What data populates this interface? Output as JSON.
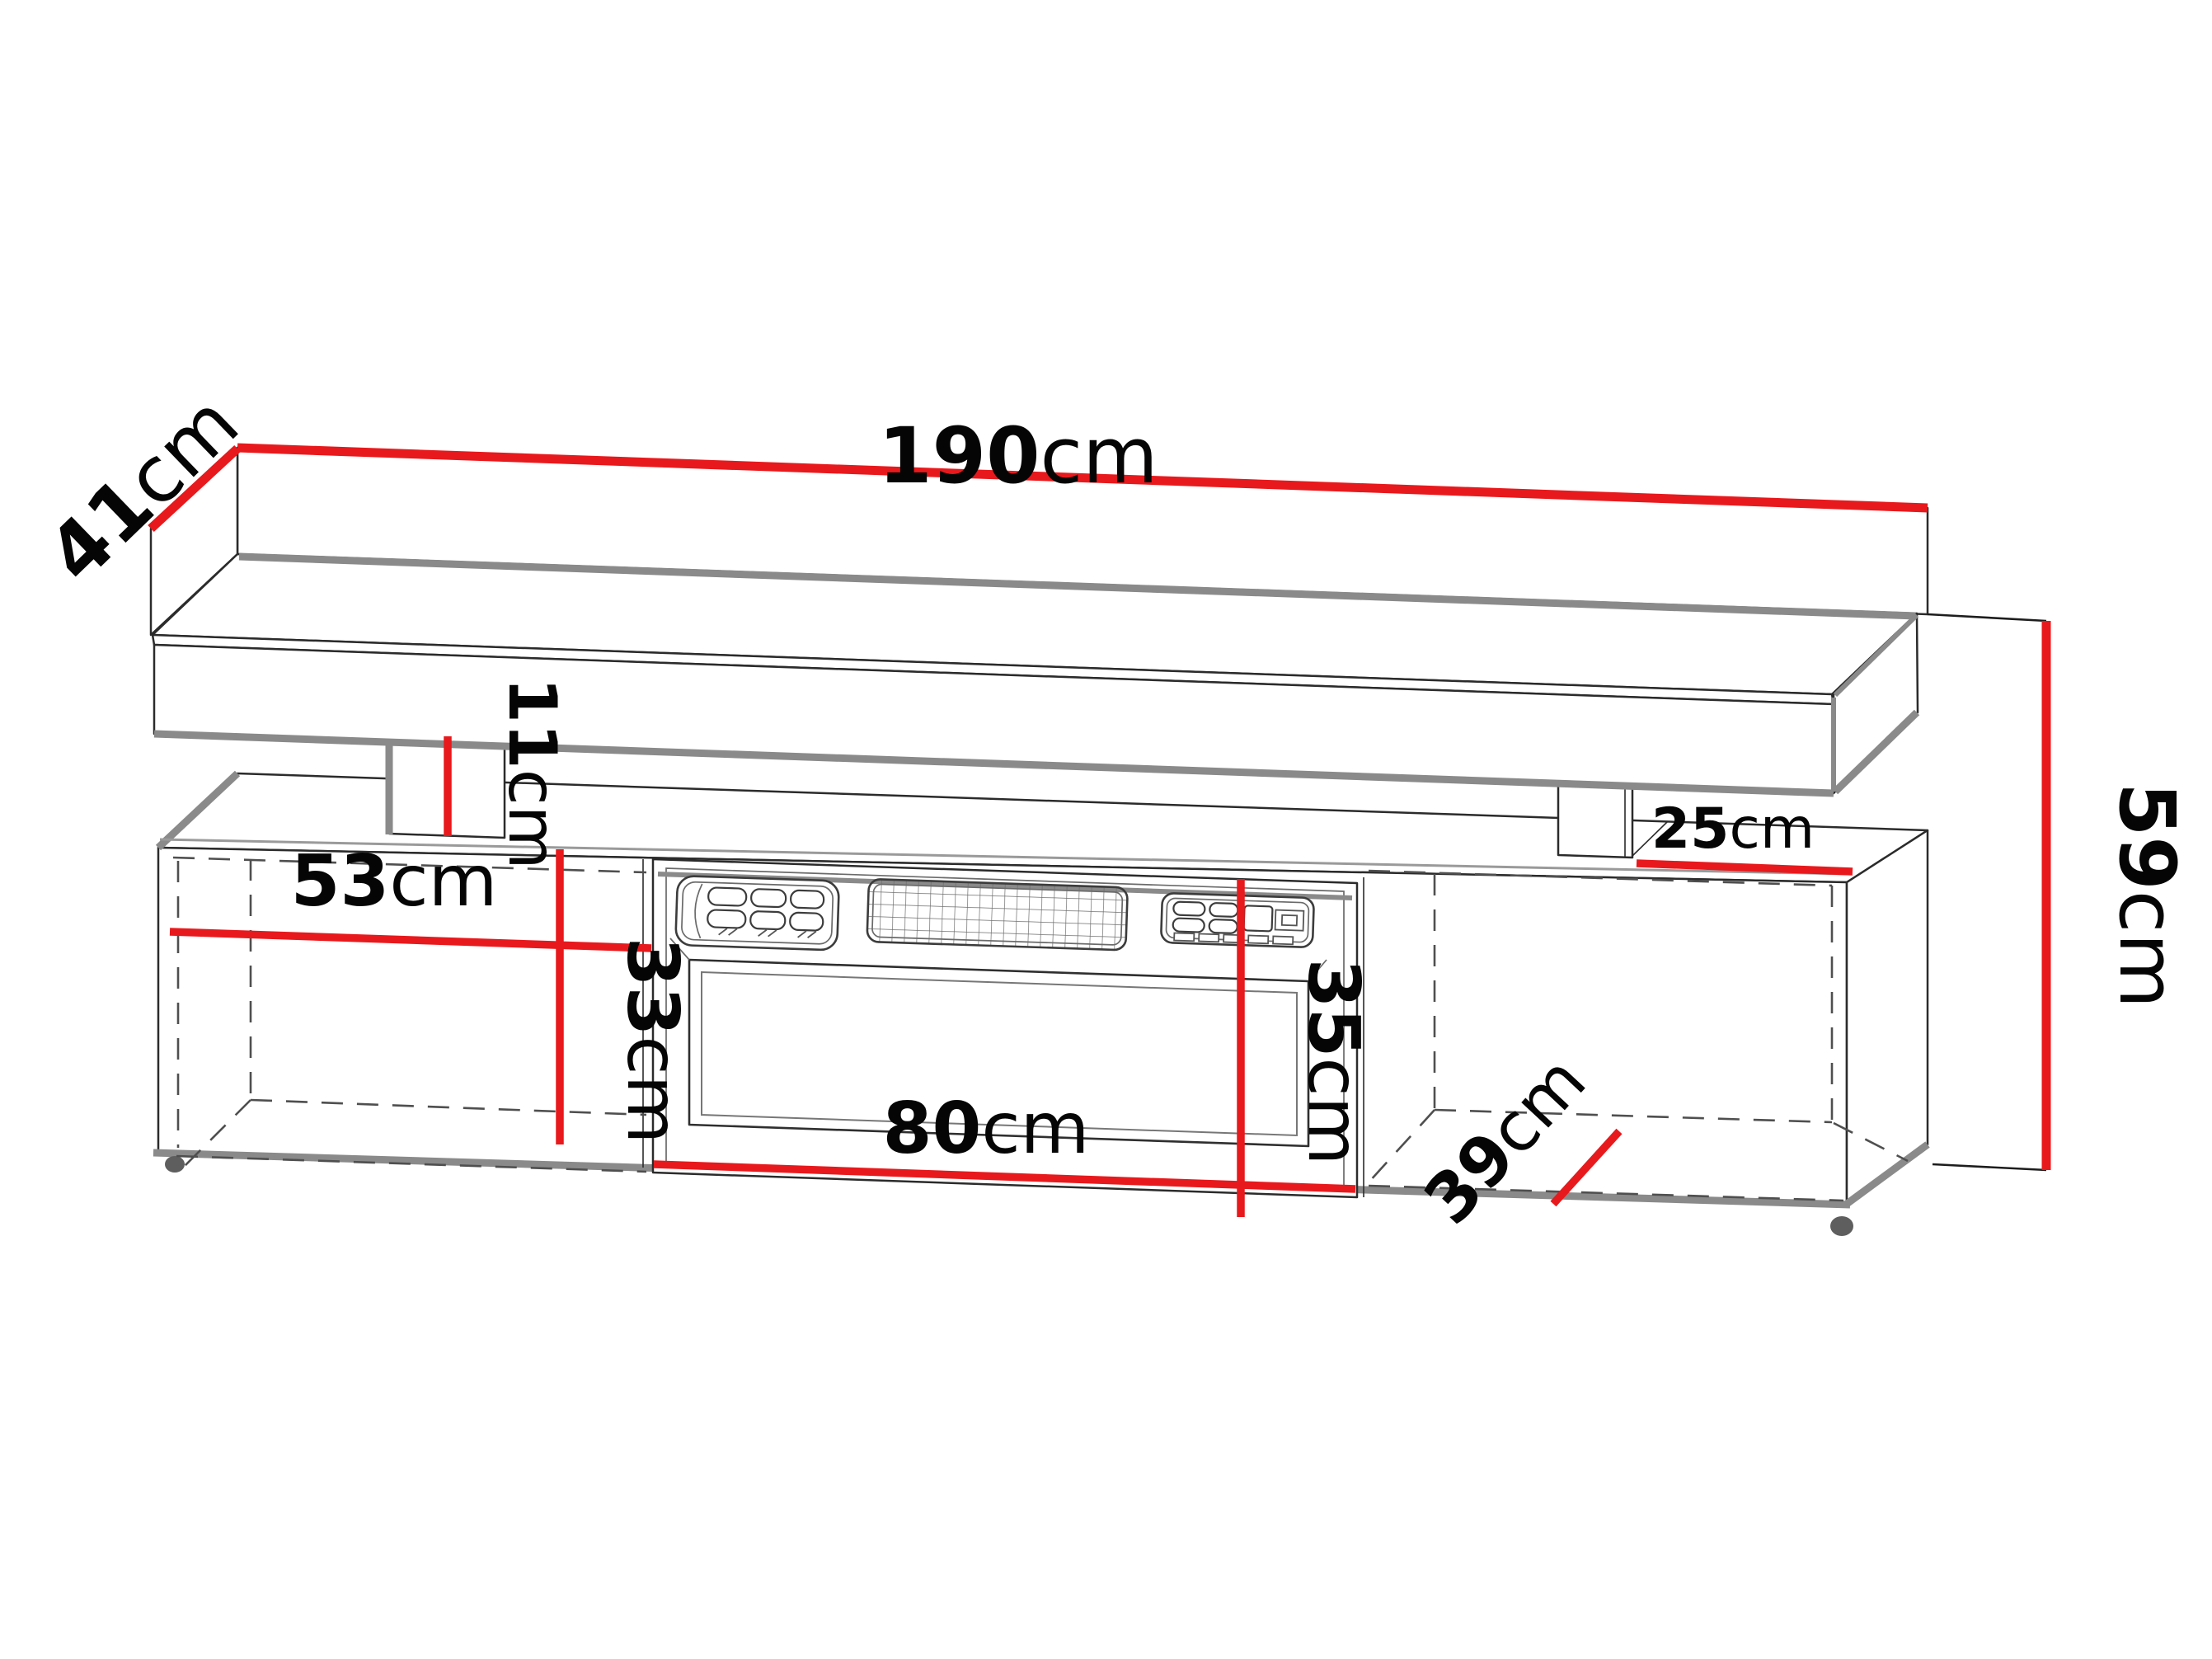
{
  "diagram": {
    "type": "furniture-dimension-diagram",
    "subject": "TV stand with electric fireplace and floating wall shelf",
    "unit": "cm"
  },
  "dimensions": {
    "shelf_width": {
      "value": "190",
      "unit": "cm"
    },
    "shelf_depth": {
      "value": "41",
      "unit": "cm"
    },
    "gap_height": {
      "value": "11",
      "unit": "cm"
    },
    "total_height": {
      "value": "59",
      "unit": "cm"
    },
    "left_section_width": {
      "value": "53",
      "unit": "cm"
    },
    "left_section_height": {
      "value": "33",
      "unit": "cm"
    },
    "fireplace_width": {
      "value": "80",
      "unit": "cm"
    },
    "fireplace_height": {
      "value": "35",
      "unit": "cm"
    },
    "right_section_width": {
      "value": "25",
      "unit": "cm"
    },
    "cabinet_depth": {
      "value": "39",
      "unit": "cm"
    }
  },
  "colors": {
    "dimension": "#e8191c",
    "edge": "#8a8a8a",
    "line": "#2b2b2b",
    "dashed": "#4f4f4f",
    "background": "#ffffff"
  }
}
